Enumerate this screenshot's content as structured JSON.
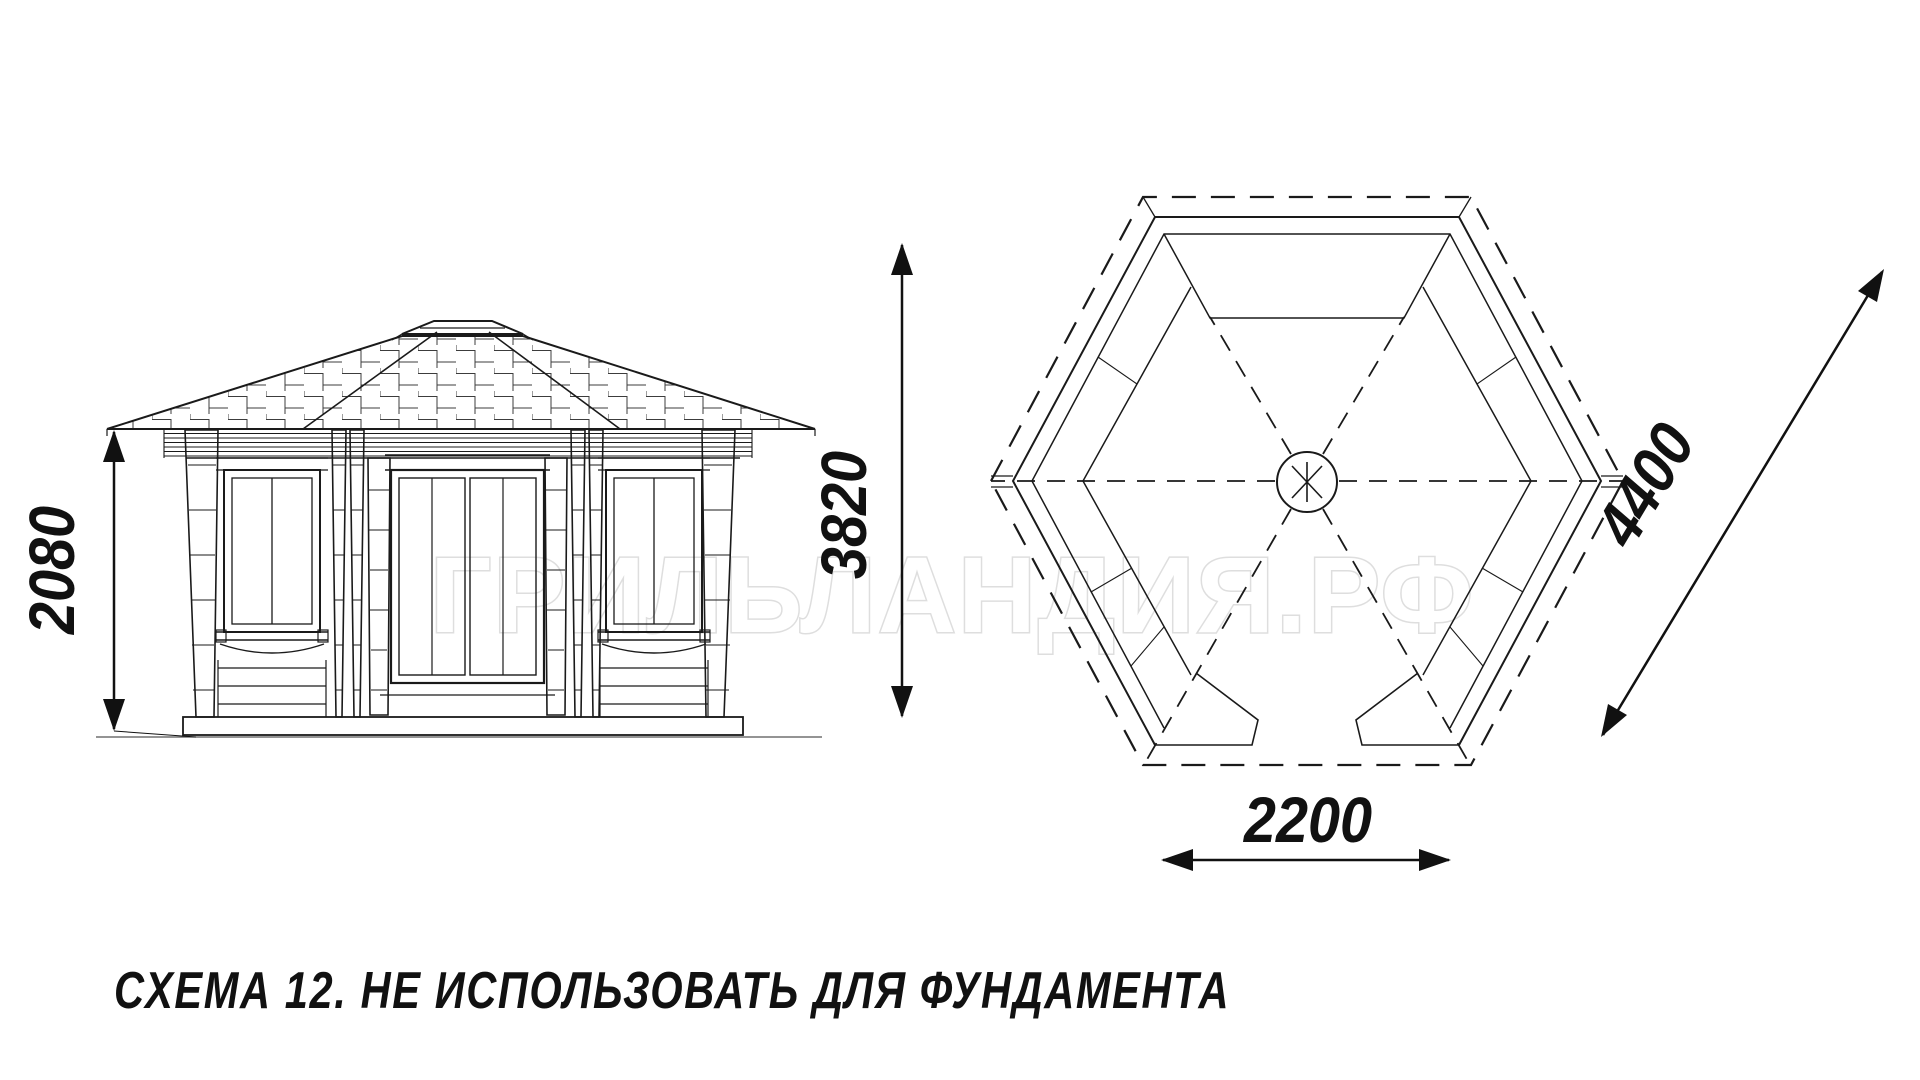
{
  "watermark": {
    "text": "ГРИЛЬЛАНДИЯ.РФ",
    "outline_color": "#d9d9d9"
  },
  "caption": {
    "text": "СХЕМА 12. НЕ ИСПОЛЬЗОВАТЬ ДЛЯ ФУНДАМЕНТА"
  },
  "dimensions": {
    "elevation_height": "2080",
    "plan_overall_height": "3820",
    "entrance_width": "2200",
    "diagonal": "4400"
  },
  "colors": {
    "ink": "#1a1a1a",
    "background": "#ffffff",
    "watermark_outline": "#d9d9d9"
  }
}
